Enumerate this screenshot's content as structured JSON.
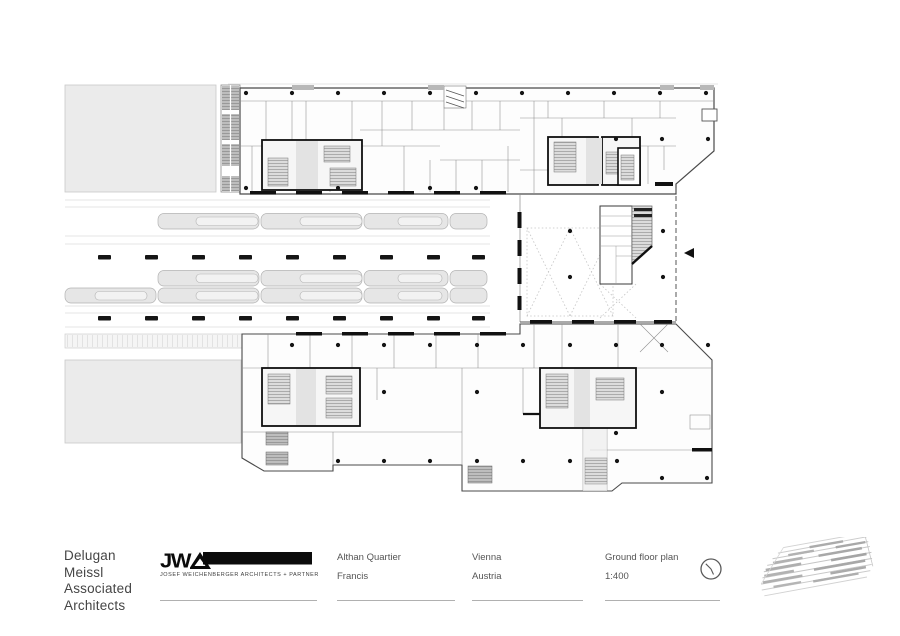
{
  "title_block": {
    "firm_name": "Delugan\nMeissl\nAssociated\nArchitects",
    "logo_letters": "JW",
    "logo_caption": "JOSEF WEICHENBERGER ARCHITECTS + PARTNER",
    "project_name": "Althan Quartier",
    "project_sub": "Francis",
    "city": "Vienna",
    "country": "Austria",
    "drawing_title": "Ground floor plan",
    "drawing_scale": "1:400"
  },
  "plan": {
    "drawing_type": "ground floor plan",
    "scale": "1:400"
  },
  "colors": {
    "paper": "#ffffff",
    "wall": "#161616",
    "light_block": "#ebebeb",
    "platform_fill": "#e6e6e6",
    "hatch_gray": "#bdbdbd",
    "text": "#4b4b4b",
    "rule": "#b0b0b0"
  }
}
